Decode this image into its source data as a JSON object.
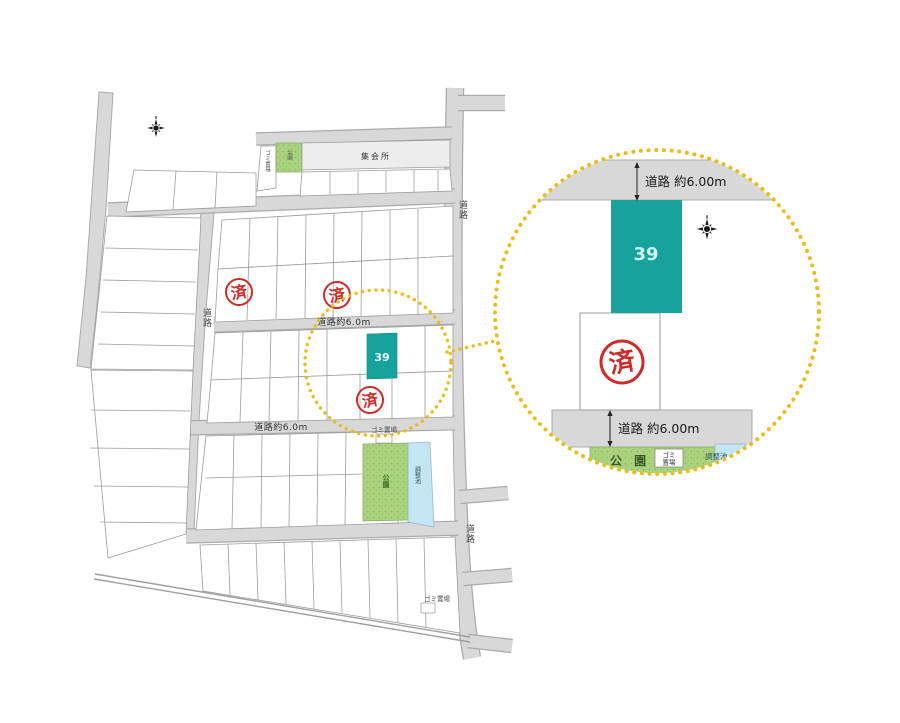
{
  "map": {
    "labels": {
      "road": "道路",
      "road_width": "道路約6.0m",
      "meeting_hall": "集会所",
      "park": "公園",
      "pond": "調整池",
      "garbage": "ゴミ置場",
      "sold": "済"
    },
    "plot39": {
      "number": "39"
    },
    "icons": {
      "compass": "compass-rose"
    }
  },
  "detail": {
    "labels": {
      "road_width_top": "道路 約6.00m",
      "road_width_bottom": "道路 約6.00m",
      "plot_number": "39",
      "sold": "済",
      "park": "公 園",
      "garbage_line1": "ゴミ",
      "garbage_line2": "置場",
      "pond": "調整池"
    },
    "icons": {
      "compass": "compass-rose"
    }
  },
  "colors": {
    "plot_teal": "#18a29e",
    "road_gray": "#d8d8d8",
    "park_green": "#abd37f",
    "pond_blue": "#c3e5f4",
    "stamp_red": "#ce2b26",
    "highlight_yellow": "#e9bd1c",
    "meeting_hall_gray": "#ededed",
    "line_gray": "#9c9c9c"
  }
}
